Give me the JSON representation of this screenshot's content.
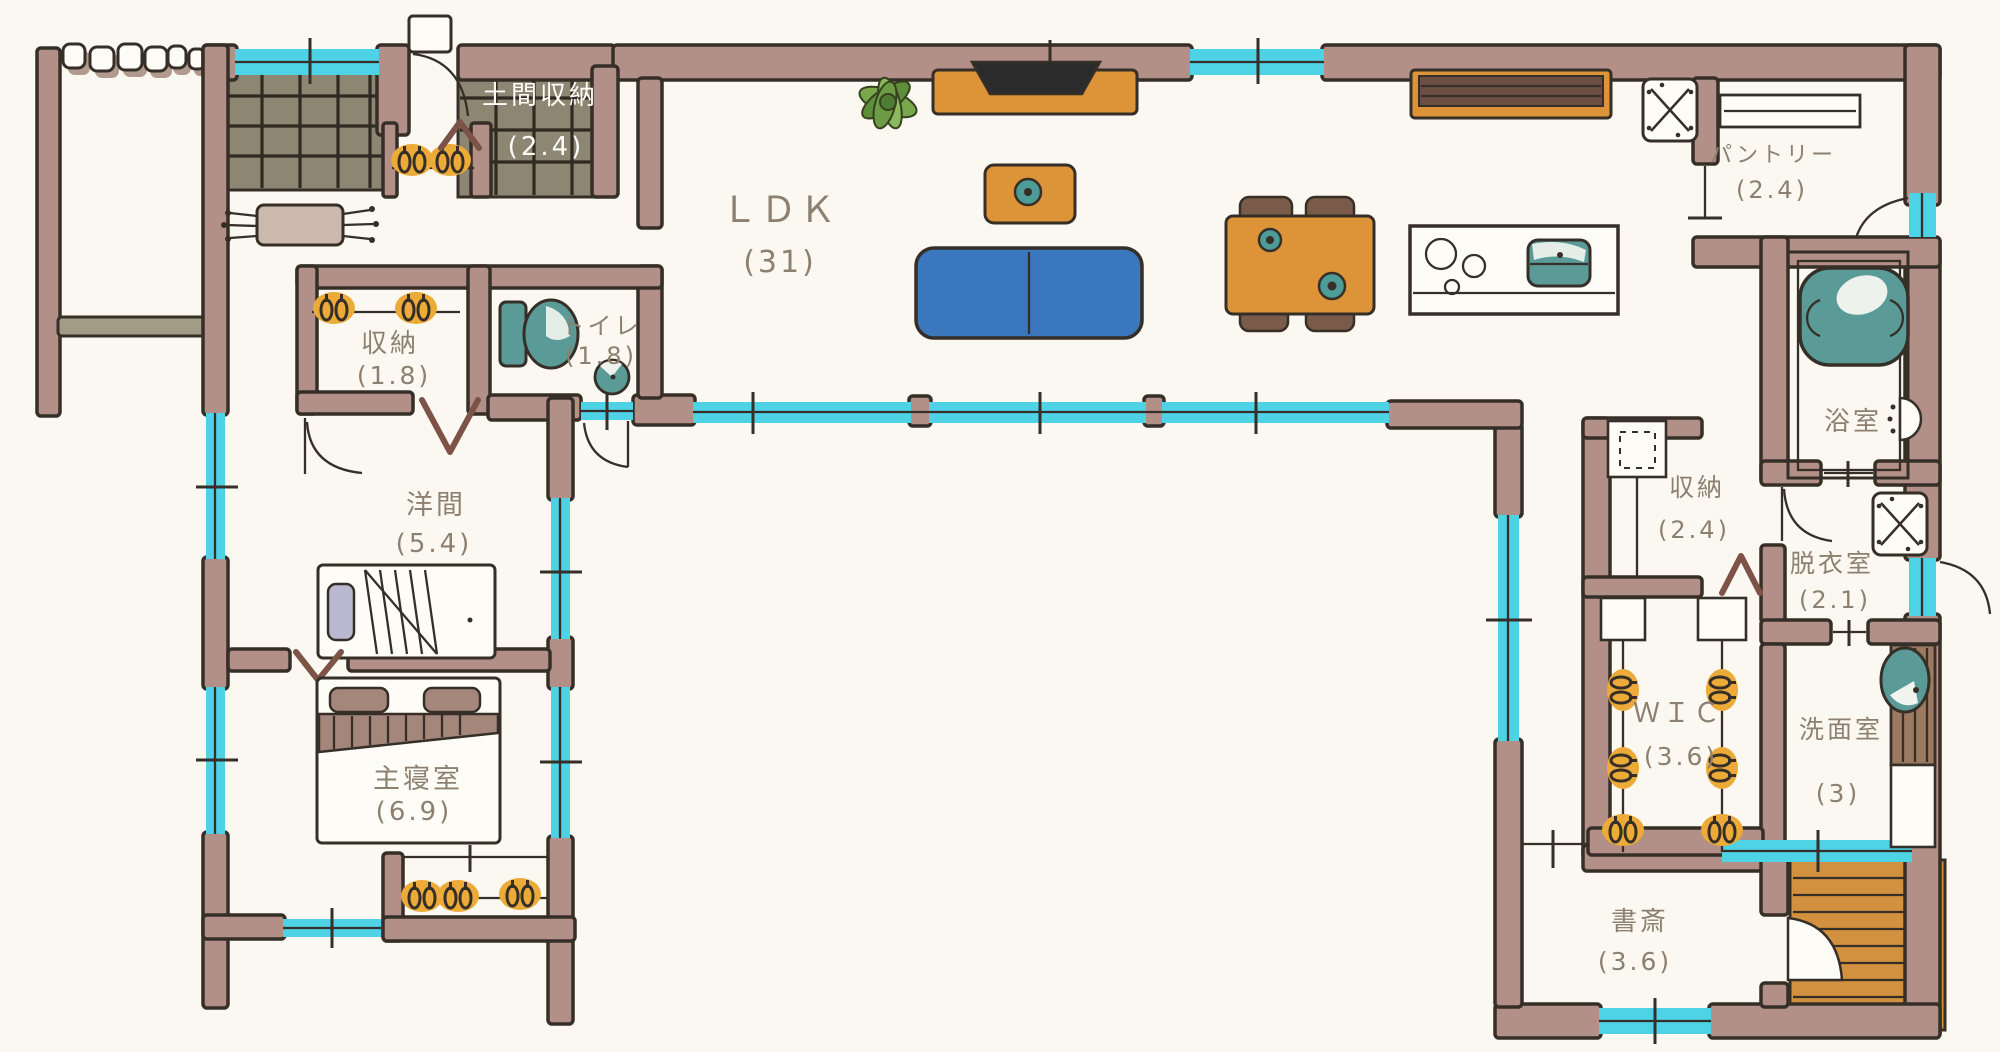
{
  "palette": {
    "wall": "#b28f87",
    "window": "#4ed2e6",
    "tile": "#8d8672",
    "furniture_orange": "#dd9338",
    "deck_wood": "#d2913f",
    "sofa_blue": "#3a77bd",
    "fixture_teal": "#5a9b98",
    "hanger_orange": "#ecaa39",
    "label_text": "#8c8070",
    "outline_ink": "#362f28"
  },
  "rooms": {
    "doma": {
      "label": "土間収納",
      "size": "(2.4)"
    },
    "ldk": {
      "label": "ＬＤＫ",
      "size": "(31)"
    },
    "closet_entry": {
      "label": "収納",
      "size": "(1.8)"
    },
    "toilet": {
      "label": "トイレ",
      "size": "(1.8)"
    },
    "western_room": {
      "label": "洋間",
      "size": "(5.4)"
    },
    "master_bedroom": {
      "label": "主寝室",
      "size": "(6.9)"
    },
    "pantry": {
      "label": "パントリー",
      "size": "(2.4)"
    },
    "bathroom": {
      "label": "浴室"
    },
    "closet_hall": {
      "label": "収納",
      "size": "(2.4)"
    },
    "dressing_room": {
      "label": "脱衣室",
      "size": "(2.1)"
    },
    "wic": {
      "label": "ＷＩＣ",
      "size": "(3.6)"
    },
    "washroom": {
      "label": "洗面室",
      "size": "(3)"
    },
    "study": {
      "label": "書斎",
      "size": "(3.6)"
    }
  }
}
